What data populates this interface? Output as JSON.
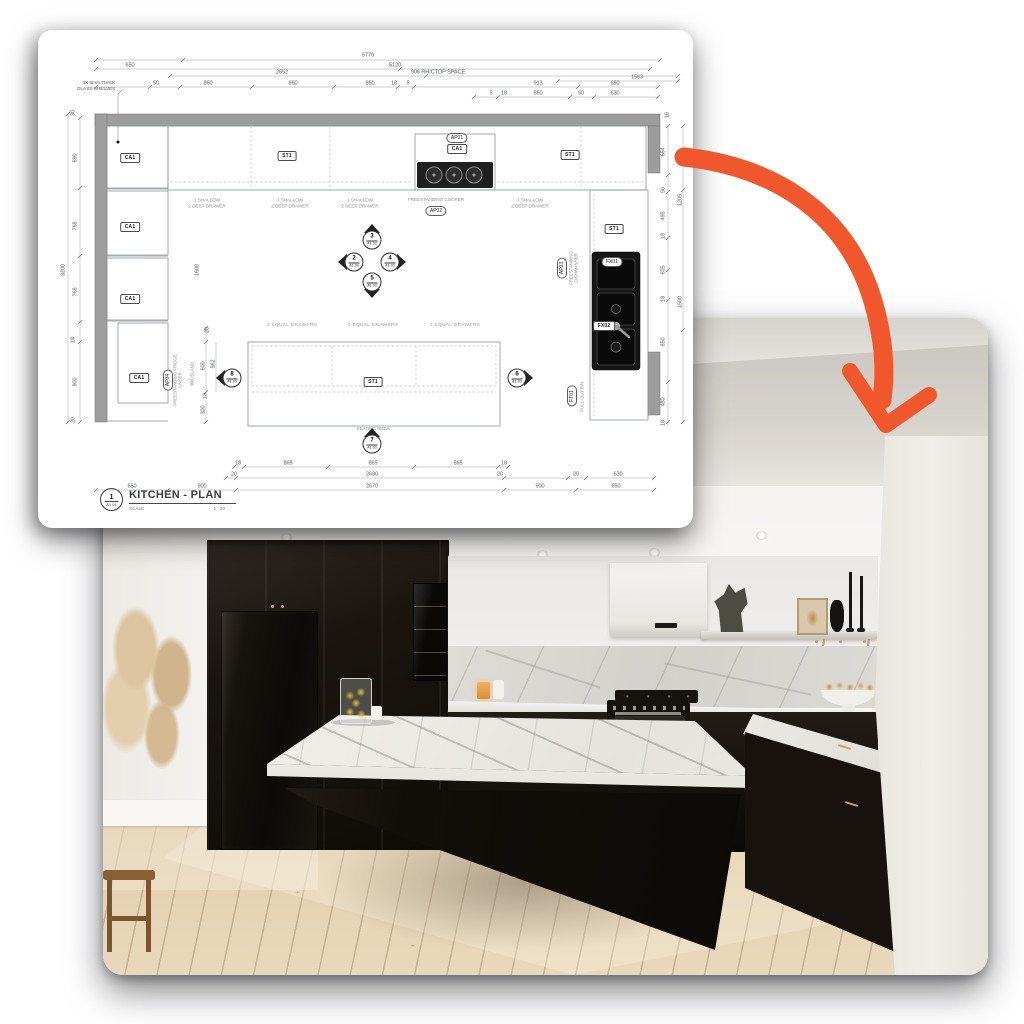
{
  "page": {
    "background": "#ffffff"
  },
  "arrow": {
    "color": "#F1572C"
  },
  "plan": {
    "title_block": {
      "number": "1",
      "sheet": "A1.01",
      "title": "KITCHEN - PLAN",
      "scale_label": "SCALE",
      "scale_value": "1 : 20"
    },
    "texts": [
      {
        "t": "650",
        "x": 92,
        "y": 36
      },
      {
        "t": "5770",
        "x": 330,
        "y": 26
      },
      {
        "t": "5120",
        "x": 357,
        "y": 36
      },
      {
        "t": "2652",
        "x": 244,
        "y": 43
      },
      {
        "t": "906 RH/CTOP SPACE",
        "x": 400,
        "y": 43
      },
      {
        "t": "1563",
        "x": 599,
        "y": 48
      },
      {
        "t": "50",
        "x": 118,
        "y": 54
      },
      {
        "t": "860",
        "x": 170,
        "y": 54
      },
      {
        "t": "860",
        "x": 255,
        "y": 54
      },
      {
        "t": "860",
        "x": 332,
        "y": 54
      },
      {
        "t": "18",
        "x": 356,
        "y": 54
      },
      {
        "t": "5",
        "x": 370,
        "y": 54
      },
      {
        "t": "913",
        "x": 500,
        "y": 54
      },
      {
        "t": "650",
        "x": 577,
        "y": 54
      },
      {
        "t": "5",
        "x": 453,
        "y": 64
      },
      {
        "t": "18",
        "x": 466,
        "y": 64
      },
      {
        "t": "860",
        "x": 500,
        "y": 64
      },
      {
        "t": "50",
        "x": 543,
        "y": 64
      },
      {
        "t": "630",
        "x": 577,
        "y": 64
      },
      {
        "t": "30",
        "x": 36,
        "y": 83,
        "r": 1
      },
      {
        "t": "690",
        "x": 38,
        "y": 128,
        "r": 1
      },
      {
        "t": "768",
        "x": 38,
        "y": 196,
        "r": 1
      },
      {
        "t": "768",
        "x": 38,
        "y": 262,
        "r": 1
      },
      {
        "t": "18",
        "x": 36,
        "y": 310,
        "r": 1
      },
      {
        "t": "900",
        "x": 38,
        "y": 352,
        "r": 1
      },
      {
        "t": "20",
        "x": 36,
        "y": 390,
        "r": 1
      },
      {
        "t": "3200",
        "x": 26,
        "y": 240,
        "r": 1
      },
      {
        "t": "1600",
        "x": 160,
        "y": 240,
        "r": 1
      },
      {
        "t": "16",
        "x": 630,
        "y": 85,
        "r": 1
      },
      {
        "t": "664",
        "x": 626,
        "y": 122,
        "r": 1
      },
      {
        "t": "50",
        "x": 626,
        "y": 160,
        "r": 1
      },
      {
        "t": "495",
        "x": 626,
        "y": 186,
        "r": 1
      },
      {
        "t": "18",
        "x": 626,
        "y": 206,
        "r": 1
      },
      {
        "t": "605",
        "x": 626,
        "y": 240,
        "r": 1
      },
      {
        "t": "18",
        "x": 626,
        "y": 269,
        "r": 1
      },
      {
        "t": "850",
        "x": 626,
        "y": 312,
        "r": 1
      },
      {
        "t": "450",
        "x": 626,
        "y": 372,
        "r": 1
      },
      {
        "t": "18",
        "x": 626,
        "y": 393,
        "r": 1
      },
      {
        "t": "700",
        "x": 643,
        "y": 127,
        "r": 1
      },
      {
        "t": "1205",
        "x": 643,
        "y": 170,
        "r": 1
      },
      {
        "t": "1500",
        "x": 643,
        "y": 272,
        "r": 1
      },
      {
        "t": "18",
        "x": 200,
        "y": 434
      },
      {
        "t": "865",
        "x": 250,
        "y": 434
      },
      {
        "t": "865",
        "x": 335,
        "y": 434
      },
      {
        "t": "865",
        "x": 420,
        "y": 434
      },
      {
        "t": "18",
        "x": 466,
        "y": 434
      },
      {
        "t": "20",
        "x": 196,
        "y": 445
      },
      {
        "t": "2630",
        "x": 334,
        "y": 445
      },
      {
        "t": "20",
        "x": 462,
        "y": 445
      },
      {
        "t": "20",
        "x": 538,
        "y": 445
      },
      {
        "t": "630",
        "x": 580,
        "y": 445
      },
      {
        "t": "650",
        "x": 94,
        "y": 457
      },
      {
        "t": "900",
        "x": 164,
        "y": 457
      },
      {
        "t": "2670",
        "x": 334,
        "y": 457
      },
      {
        "t": "900",
        "x": 502,
        "y": 457
      },
      {
        "t": "650",
        "x": 578,
        "y": 457
      },
      {
        "t": "20",
        "x": 170,
        "y": 300,
        "r": 1
      },
      {
        "t": "562",
        "x": 176,
        "y": 334,
        "r": 1
      },
      {
        "t": "600",
        "x": 166,
        "y": 336,
        "r": 1
      },
      {
        "t": "18",
        "x": 168,
        "y": 366,
        "r": 1
      },
      {
        "t": "300",
        "x": 166,
        "y": 380,
        "r": 1
      },
      {
        "t": "900 ISLAND",
        "x": 154,
        "y": 344,
        "r": 1,
        "c": "rl"
      },
      {
        "t": "FREESTANDING FRIDGE\nUNDER",
        "x": 140,
        "y": 350,
        "r": 1,
        "c": "rl"
      },
      {
        "t": "FREESTANDING\nDISHWASHER",
        "x": 536,
        "y": 238,
        "r": 1,
        "c": "rl"
      },
      {
        "t": "PULL-OUT BIN",
        "x": 544,
        "y": 367,
        "r": 1,
        "c": "rl"
      },
      {
        "t": "1 SHALLOW\n2 DEEP DRAWER",
        "x": 169,
        "y": 173,
        "c": "lab"
      },
      {
        "t": "1 SHALLOW\n2 DEEP DRAWER",
        "x": 252,
        "y": 173,
        "c": "lab"
      },
      {
        "t": "1 SHALLOW\n2 DEEP DRAWER",
        "x": 322,
        "y": 173,
        "c": "lab"
      },
      {
        "t": "1 SHALLOW\n2 DEEP DRAWER",
        "x": 492,
        "y": 173,
        "c": "lab"
      },
      {
        "t": "FREESTANDING COOKER",
        "x": 398,
        "y": 170,
        "c": "lab"
      },
      {
        "t": "3 EQUAL DRAWERS",
        "x": 254,
        "y": 296,
        "c": "labd"
      },
      {
        "t": "3 EQUAL DRAWERS",
        "x": 335,
        "y": 296,
        "c": "labd"
      },
      {
        "t": "3 EQUAL DRAWERS",
        "x": 417,
        "y": 296,
        "c": "labd"
      },
      {
        "t": "SEATING AREA",
        "x": 335,
        "y": 399,
        "c": "lab"
      },
      {
        "t": "3X 8mm THICK\nGLASS SHELVES",
        "x": 58,
        "y": 57,
        "c": "note"
      }
    ],
    "chips": [
      {
        "t": "CA1",
        "x": 92,
        "y": 128,
        "kind": "rect"
      },
      {
        "t": "CA1",
        "x": 92,
        "y": 197,
        "kind": "rect"
      },
      {
        "t": "CA1",
        "x": 92,
        "y": 269,
        "kind": "rect"
      },
      {
        "t": "CA1",
        "x": 101,
        "y": 348,
        "kind": "rect"
      },
      {
        "t": "CA1",
        "x": 419,
        "y": 119,
        "kind": "rect"
      },
      {
        "t": "ST1",
        "x": 249,
        "y": 126,
        "kind": "rect"
      },
      {
        "t": "ST1",
        "x": 532,
        "y": 125,
        "kind": "rect"
      },
      {
        "t": "ST1",
        "x": 576,
        "y": 199,
        "kind": "rect"
      },
      {
        "t": "ST1",
        "x": 335,
        "y": 352,
        "kind": "rect"
      },
      {
        "t": "FX02",
        "x": 566,
        "y": 296,
        "kind": "rect"
      },
      {
        "t": "AP01",
        "x": 419,
        "y": 108,
        "kind": "oval"
      },
      {
        "t": "AP02",
        "x": 398,
        "y": 181,
        "kind": "oval"
      },
      {
        "t": "FX01",
        "x": 574,
        "y": 232,
        "kind": "oval"
      },
      {
        "t": "AP03",
        "x": 524,
        "y": 238,
        "kind": "oval",
        "r": 1
      },
      {
        "t": "AP04",
        "x": 130,
        "y": 350,
        "kind": "oval",
        "r": 1
      },
      {
        "t": "FT01",
        "x": 534,
        "y": 366,
        "kind": "oval",
        "r": 1
      }
    ],
    "markers": [
      {
        "num": "3",
        "sheet": "A1.03",
        "x": 334,
        "y": 210,
        "dir": "up"
      },
      {
        "num": "2",
        "sheet": "A1.03",
        "x": 316,
        "y": 232,
        "dir": "left"
      },
      {
        "num": "4",
        "sheet": "A1.03",
        "x": 352,
        "y": 232,
        "dir": "right"
      },
      {
        "num": "5",
        "sheet": "A1.03",
        "x": 334,
        "y": 252,
        "dir": "down"
      },
      {
        "num": "8",
        "sheet": "A1.03",
        "x": 194,
        "y": 348,
        "dir": "left"
      },
      {
        "num": "6",
        "sheet": "A1.03",
        "x": 479,
        "y": 348,
        "dir": "right"
      },
      {
        "num": "7",
        "sheet": "A1.03",
        "x": 334,
        "y": 414,
        "dir": "up"
      }
    ]
  },
  "photo": {
    "alt": "Completed kitchen photograph: black shaker cabinetry, integrated black fridge, white marble island with a glass jar of lemons, marble splashback, white rangehood, floating shelf with decor and light timber floor."
  }
}
